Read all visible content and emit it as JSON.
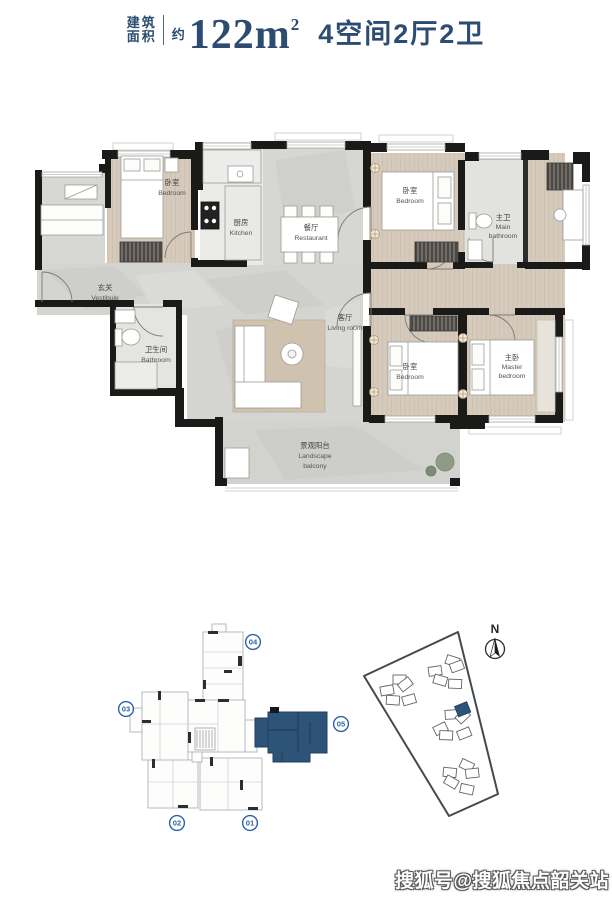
{
  "header": {
    "area_label_line1": "建筑",
    "area_label_line2": "面积",
    "approx": "约",
    "area_value": "122m",
    "area_sup": "2",
    "layout": "4空间2厅2卫"
  },
  "floorplan": {
    "rooms": [
      {
        "cn": "卧室",
        "en_lines": [
          "Bedroom"
        ]
      },
      {
        "cn": "厨房",
        "en_lines": [
          "Kitchen"
        ]
      },
      {
        "cn": "餐厅",
        "en_lines": [
          "Restaurant"
        ]
      },
      {
        "cn": "玄关",
        "en_lines": [
          "Vestibule"
        ]
      },
      {
        "cn": "卧室",
        "en_lines": [
          "Bedroom"
        ]
      },
      {
        "cn": "主卫",
        "en_lines": [
          "Main",
          "bathroom"
        ]
      },
      {
        "cn": "卫生间",
        "en_lines": [
          "Bathroom"
        ]
      },
      {
        "cn": "客厅",
        "en_lines": [
          "Living room"
        ]
      },
      {
        "cn": "卧室",
        "en_lines": [
          "Bedroom"
        ]
      },
      {
        "cn": "主卧",
        "en_lines": [
          "Master",
          "bedroom"
        ]
      },
      {
        "cn": "景观阳台",
        "en_lines": [
          "Landscape",
          "balcony"
        ]
      }
    ]
  },
  "keyplan": {
    "units": [
      {
        "label": "01"
      },
      {
        "label": "02"
      },
      {
        "label": "03"
      },
      {
        "label": "04"
      },
      {
        "label": "05"
      }
    ],
    "highlighted_unit": "05"
  },
  "siteplan": {
    "north_label": "N"
  },
  "watermark": {
    "text": "搜狐号@搜狐焦点韶关站"
  },
  "colors": {
    "accent_navy": "#2d4c71",
    "unit_highlight": "#2e5378",
    "circle_blue": "#2a62a8"
  }
}
